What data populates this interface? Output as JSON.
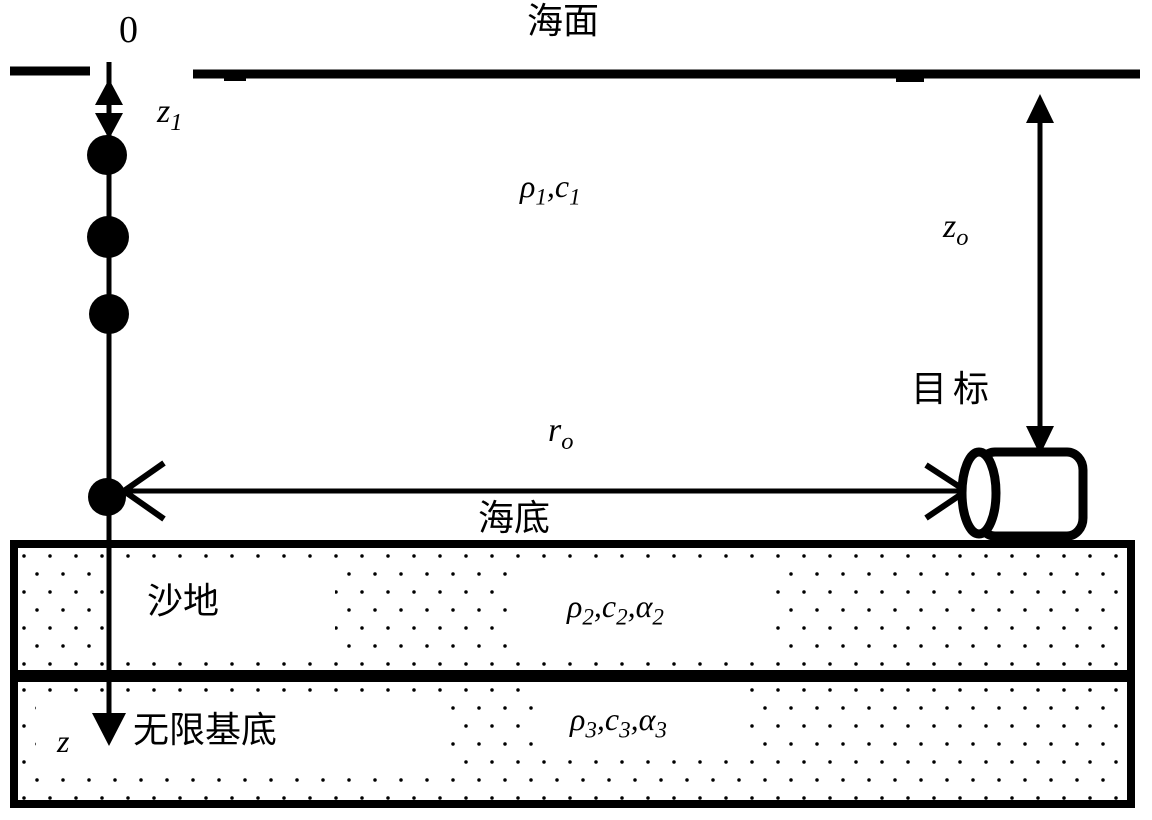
{
  "colors": {
    "ink": "#000000",
    "paper": "#ffffff"
  },
  "surface": {
    "origin_label": "0",
    "sea_surface_label": "海面"
  },
  "water_column": {
    "medium1": {
      "p1": "ρ",
      "s1": "1",
      "p2": ",c",
      "s2": "1"
    },
    "array_top_depth": {
      "base": "z",
      "sub": "1"
    },
    "hydrophone_count": 4
  },
  "target": {
    "name_label": "目标",
    "depth": {
      "base": "z",
      "sub": "o"
    },
    "range": {
      "base": "r",
      "sub": "o"
    }
  },
  "seabed": {
    "seabed_label": "海底",
    "sand_label": "沙地",
    "medium2": {
      "p1": "ρ",
      "s1": "2",
      "p2": ",c",
      "s2": "2",
      "p3": ",α",
      "s3": "2"
    },
    "basement_label": "无限基底",
    "medium3": {
      "p1": "ρ",
      "s1": "3",
      "p2": ",c",
      "s2": "3",
      "p3": ",α",
      "s3": "3"
    }
  },
  "axes": {
    "z_axis_label": "z"
  }
}
